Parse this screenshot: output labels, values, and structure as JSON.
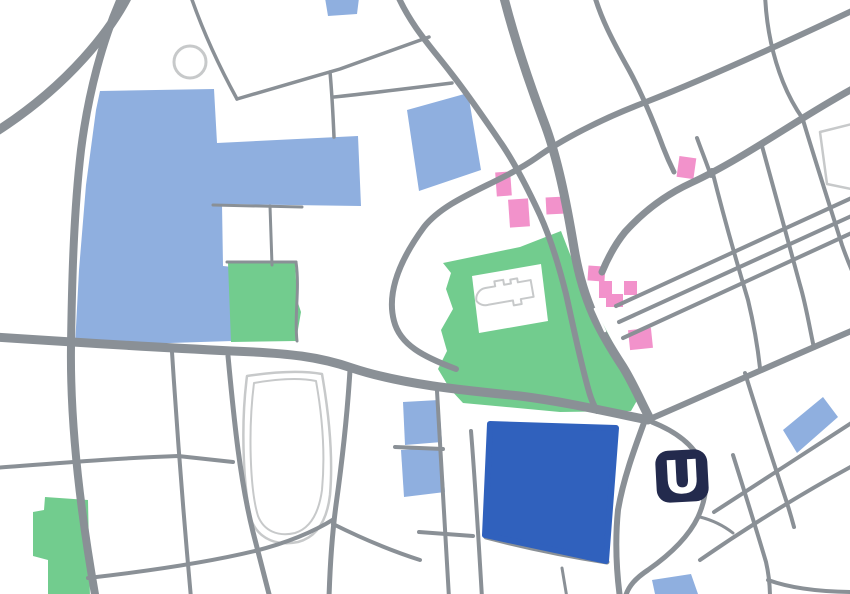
{
  "map": {
    "type": "stylized-street-map",
    "station_logo": {
      "label": "U"
    },
    "colors": {
      "background": "#FFFFFF",
      "road": "#8A9096",
      "water": "#8FAFDF",
      "park": "#72CC8E",
      "landmark": "#F292CB",
      "highlight": "#3061BD",
      "navy": "#232A4D",
      "outline": "#C7C9CA"
    },
    "features": {
      "light_blue_areas": 8,
      "park_areas": 3,
      "pink_buildings": 9,
      "highlight_blocks": 1,
      "outlined_landmarks": [
        "pond-circle",
        "church-footprint",
        "stadium-grounds",
        "corner-plot"
      ]
    }
  }
}
